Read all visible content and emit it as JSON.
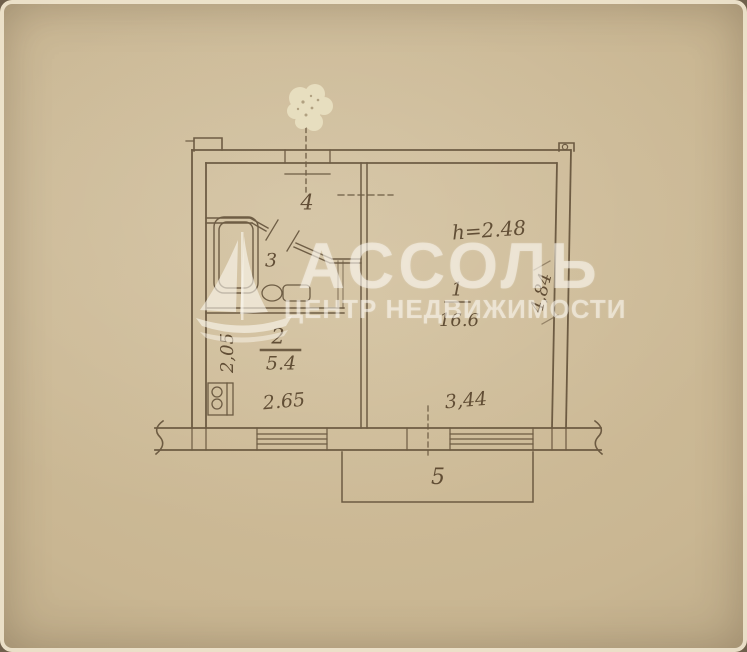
{
  "watermark": {
    "brand": "АССОЛЬ",
    "tagline": "ЦЕНТР НЕДВИЖИМОСТИ"
  },
  "floor_plan": {
    "rooms": {
      "living_number": "1",
      "living_area": "16.6",
      "kitchen_number": "2",
      "kitchen_area": "5.4",
      "bathroom_number": "3",
      "hall_number": "4",
      "balcony_number": "5"
    },
    "dimensions": {
      "ceiling_height": "h=2.48",
      "kitchen_width": "2.65",
      "kitchen_depth": "2,05",
      "living_width": "3,44",
      "living_depth": "4,84"
    }
  },
  "colors": {
    "paper": "#c9b692",
    "ink": "#52402a",
    "watermark_text": "rgba(252,248,240,0.55)"
  }
}
